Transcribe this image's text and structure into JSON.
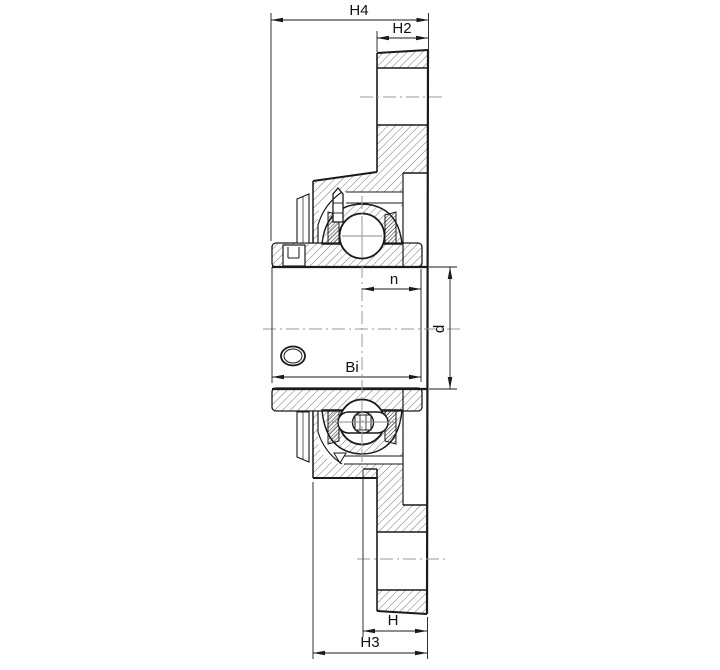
{
  "drawing": {
    "kind": "engineering-section-drawing",
    "subject": "flanged bearing unit cross-section",
    "background": "#ffffff",
    "line_color": "#1a1a1a",
    "centerline_color": "#999999",
    "hatch_color": "#3a3a3a",
    "labels": {
      "h4": "H4",
      "h2": "H2",
      "n": "n",
      "d": "d",
      "bi": "Bi",
      "h": "H",
      "h3": "H3"
    }
  }
}
